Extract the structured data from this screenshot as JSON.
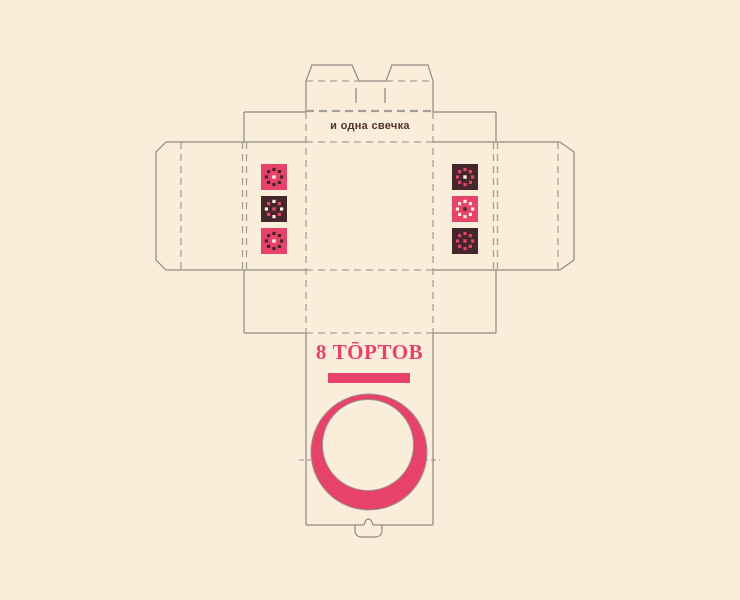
{
  "palette": {
    "background": "#faeeda",
    "pink": "#e7426a",
    "brown": "#45262a",
    "cream": "#f8efe0",
    "cut_line": "#8d8b83",
    "fold_line": "#a3a098",
    "text_dark": "#54302c"
  },
  "lid_panel": {
    "label": "и одна свечка"
  },
  "front_panel": {
    "brand_logo": "8 ТŌРТОВ"
  },
  "pattern_tiles": {
    "left": [
      {
        "bg": "pink",
        "dots": [
          "brown",
          "brown",
          "brown",
          "brown",
          "brown",
          "brown",
          "brown",
          "brown"
        ],
        "center": "cream"
      },
      {
        "bg": "brown",
        "dots": [
          "cream",
          "pink",
          "cream",
          "pink",
          "cream",
          "pink",
          "cream",
          "pink"
        ],
        "center": "pink"
      },
      {
        "bg": "pink",
        "dots": [
          "brown",
          "brown",
          "brown",
          "brown",
          "brown",
          "brown",
          "brown",
          "brown"
        ],
        "center": "cream"
      }
    ],
    "right": [
      {
        "bg": "brown",
        "dots": [
          "pink",
          "pink",
          "pink",
          "pink",
          "pink",
          "pink",
          "pink",
          "pink"
        ],
        "center": "cream"
      },
      {
        "bg": "pink",
        "dots": [
          "cream",
          "cream",
          "cream",
          "cream",
          "cream",
          "cream",
          "cream",
          "cream"
        ],
        "center": "brown"
      },
      {
        "bg": "brown",
        "dots": [
          "pink",
          "pink",
          "pink",
          "pink",
          "pink",
          "pink",
          "pink",
          "pink"
        ],
        "center": "pink"
      }
    ]
  }
}
